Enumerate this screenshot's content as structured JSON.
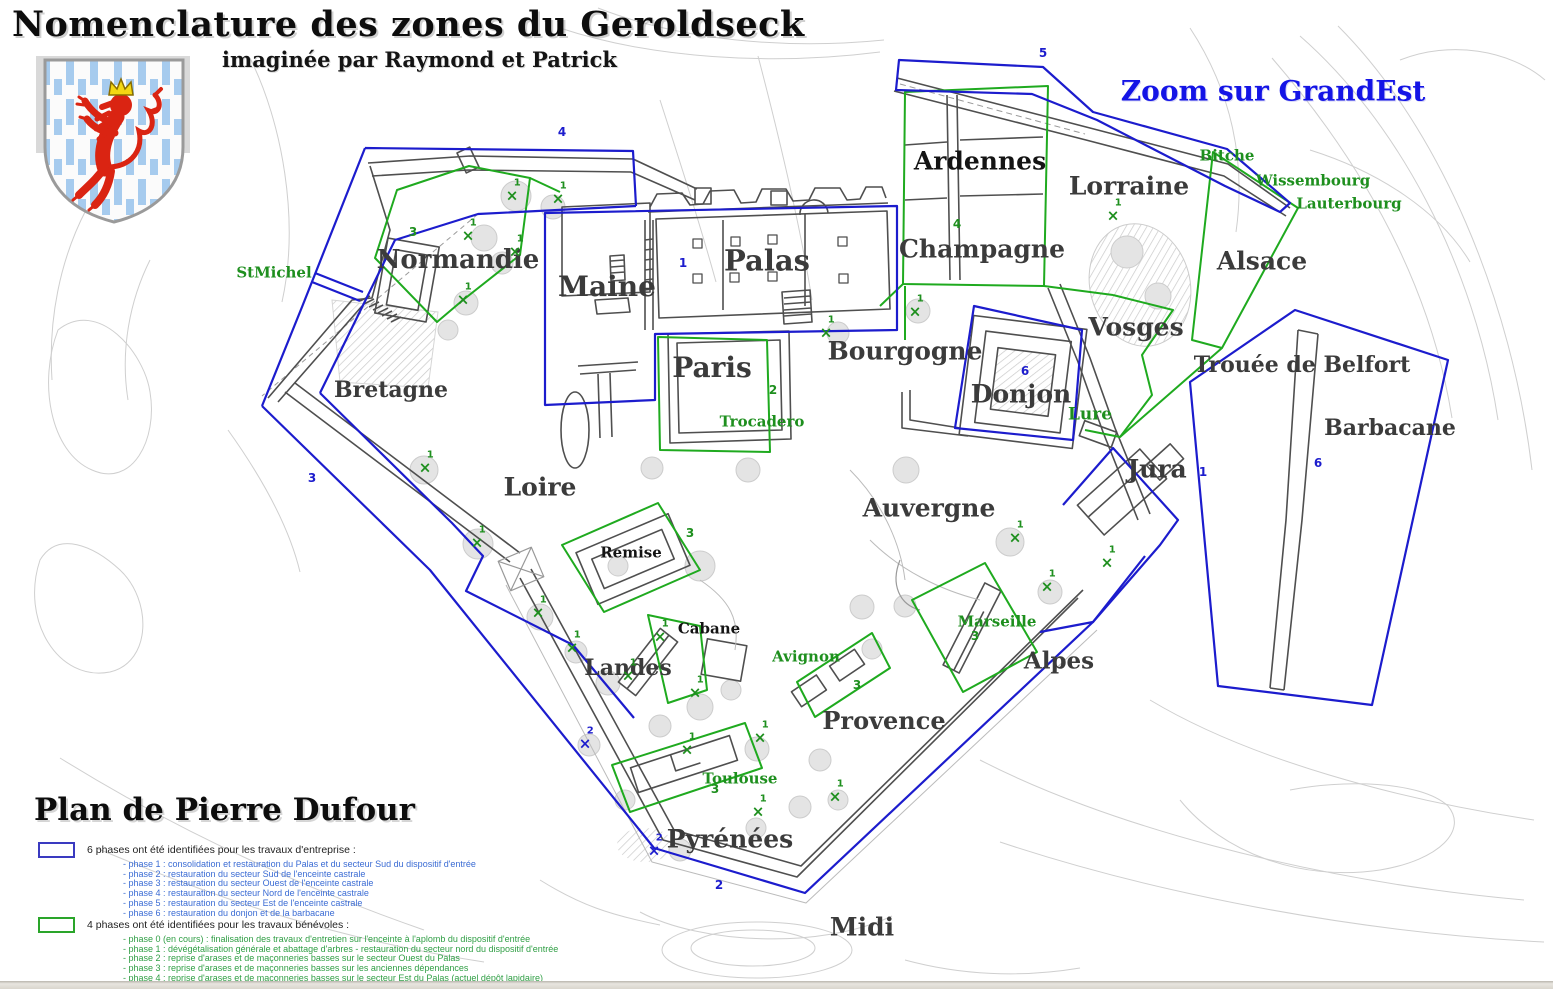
{
  "header": {
    "title": "Nomenclature des zones du Geroldseck",
    "subtitle": "imaginée par Raymond et Patrick",
    "zoom_note": "Zoom sur GrandEst",
    "plan_credit": "Plan de Pierre Dufour"
  },
  "colors": {
    "phase_blue": "#1c1ccd",
    "phase_green": "#1faa1f",
    "green_label": "#1e8f1e",
    "zoom_note_blue": "#1414e6",
    "legend_blue_text": "#3b6cd4",
    "legend_green_text": "#2f9e44",
    "region_label_dark": "#3b3b3b",
    "wall_gray": "#4f4f4f",
    "contour_gray": "#cfcfcf"
  },
  "legend_entreprise": {
    "header": "6 phases ont été identifiées pour les travaux d'entreprise :",
    "lines": [
      {
        "text": "- phase 1 : consolidation et restauration du Palas et du secteur Sud du dispositif d'entrée"
      },
      {
        "text": "- phase 2 : restauration du secteur Sud de l'enceinte castrale"
      },
      {
        "text": "- phase 3 : restauration du secteur Ouest de l'enceinte castrale"
      },
      {
        "text": "- phase 4 : restauration du secteur Nord de l'enceinte castrale"
      },
      {
        "text": "- phase 5 : restauration du secteur Est de l'enceinte castrale"
      },
      {
        "text": "- phase 6 : restauration du donjon et de la barbacane"
      }
    ]
  },
  "legend_benevoles": {
    "header": "4 phases ont été identifiées pour les travaux bénévoles :",
    "lines": [
      {
        "text": "- phase 0 (en cours) : finalisation des travaux d'entretien sur l'enceinte à l'aplomb du dispositif d'entrée"
      },
      {
        "text": "- phase 1 : dévégétalisation générale et abattage d'arbres - restauration du secteur nord du dispositif d'entrée"
      },
      {
        "text": "- phase 2 : reprise d'arases et de maçonneries basses sur le secteur Ouest du Palas"
      },
      {
        "text": "- phase 3 : reprise d'arases et de maçonneries basses sur les anciennes dépendances"
      },
      {
        "text": "- phase 4 : reprise d'arases et de maçonneries basses sur le secteur Est du Palas (actuel dépôt lapidaire)"
      }
    ]
  },
  "map": {
    "region_labels": [
      {
        "text": "Palas",
        "x": 767,
        "y": 261,
        "size": 29,
        "tone": "dark"
      },
      {
        "text": "Maine",
        "x": 607,
        "y": 287,
        "size": 28,
        "tone": "dark"
      },
      {
        "text": "Paris",
        "x": 712,
        "y": 368,
        "size": 28,
        "tone": "dark"
      },
      {
        "text": "Bourgogne",
        "x": 905,
        "y": 351,
        "size": 25,
        "tone": "dark"
      },
      {
        "text": "Normandie",
        "x": 458,
        "y": 260,
        "size": 26,
        "tone": "dark"
      },
      {
        "text": "Bretagne",
        "x": 391,
        "y": 390,
        "size": 22,
        "tone": "dark"
      },
      {
        "text": "Loire",
        "x": 540,
        "y": 487,
        "size": 25,
        "tone": "dark"
      },
      {
        "text": "Auvergne",
        "x": 929,
        "y": 508,
        "size": 25,
        "tone": "dark"
      },
      {
        "text": "Ardennes",
        "x": 980,
        "y": 161,
        "size": 25,
        "tone": "black"
      },
      {
        "text": "Lorraine",
        "x": 1129,
        "y": 186,
        "size": 25,
        "tone": "dark"
      },
      {
        "text": "Champagne",
        "x": 982,
        "y": 249,
        "size": 25,
        "tone": "dark"
      },
      {
        "text": "Alsace",
        "x": 1262,
        "y": 261,
        "size": 25,
        "tone": "dark"
      },
      {
        "text": "Vosges",
        "x": 1136,
        "y": 327,
        "size": 25,
        "tone": "dark"
      },
      {
        "text": "Trouée de Belfort",
        "x": 1302,
        "y": 365,
        "size": 22,
        "tone": "dark"
      },
      {
        "text": "Barbacane",
        "x": 1390,
        "y": 428,
        "size": 22,
        "tone": "dark"
      },
      {
        "text": "Donjon",
        "x": 1021,
        "y": 394,
        "size": 25,
        "tone": "dark"
      },
      {
        "text": "Jura",
        "x": 1157,
        "y": 469,
        "size": 25,
        "tone": "dark"
      },
      {
        "text": "Alpes",
        "x": 1059,
        "y": 661,
        "size": 23,
        "tone": "dark"
      },
      {
        "text": "Landes",
        "x": 628,
        "y": 668,
        "size": 22,
        "tone": "dark"
      },
      {
        "text": "Provence",
        "x": 884,
        "y": 721,
        "size": 24,
        "tone": "dark"
      },
      {
        "text": "Pyrénées",
        "x": 730,
        "y": 839,
        "size": 25,
        "tone": "dark"
      },
      {
        "text": "Midi",
        "x": 862,
        "y": 927,
        "size": 25,
        "tone": "dark"
      },
      {
        "text": "Remise",
        "x": 631,
        "y": 553,
        "size": 15,
        "tone": "black"
      },
      {
        "text": "Cabane",
        "x": 709,
        "y": 629,
        "size": 15,
        "tone": "black"
      }
    ],
    "place_labels_green": [
      {
        "text": "StMichel",
        "x": 274,
        "y": 273,
        "size": 15,
        "tone": "green"
      },
      {
        "text": "Bitche",
        "x": 1227,
        "y": 156,
        "size": 15,
        "tone": "green"
      },
      {
        "text": "Wissembourg",
        "x": 1313,
        "y": 181,
        "size": 15,
        "tone": "green"
      },
      {
        "text": "Lauterbourg",
        "x": 1349,
        "y": 204,
        "size": 15,
        "tone": "green"
      },
      {
        "text": "Trocadero",
        "x": 762,
        "y": 422,
        "size": 15,
        "tone": "green"
      },
      {
        "text": "Lure",
        "x": 1090,
        "y": 415,
        "size": 17,
        "tone": "green"
      },
      {
        "text": "Marseille",
        "x": 997,
        "y": 622,
        "size": 15,
        "tone": "green"
      },
      {
        "text": "Avignon",
        "x": 806,
        "y": 657,
        "size": 15,
        "tone": "green"
      },
      {
        "text": "Toulouse",
        "x": 740,
        "y": 779,
        "size": 15,
        "tone": "green"
      }
    ],
    "zone_numbers": [
      {
        "text": "5",
        "x": 1043,
        "y": 53,
        "tone": "blue"
      },
      {
        "text": "4",
        "x": 562,
        "y": 132,
        "tone": "blue"
      },
      {
        "text": "3",
        "x": 312,
        "y": 478,
        "tone": "blue"
      },
      {
        "text": "2",
        "x": 719,
        "y": 885,
        "tone": "blue"
      },
      {
        "text": "1",
        "x": 683,
        "y": 263,
        "tone": "blue"
      },
      {
        "text": "6",
        "x": 1025,
        "y": 371,
        "tone": "blue"
      },
      {
        "text": "6",
        "x": 1318,
        "y": 463,
        "tone": "blue"
      },
      {
        "text": "1",
        "x": 1203,
        "y": 472,
        "tone": "blue"
      },
      {
        "text": "3",
        "x": 413,
        "y": 232,
        "tone": "green"
      },
      {
        "text": "4",
        "x": 957,
        "y": 224,
        "tone": "green"
      },
      {
        "text": "2",
        "x": 773,
        "y": 390,
        "tone": "green"
      },
      {
        "text": "3",
        "x": 690,
        "y": 533,
        "tone": "green"
      },
      {
        "text": "3",
        "x": 857,
        "y": 685,
        "tone": "green"
      },
      {
        "text": "3",
        "x": 715,
        "y": 789,
        "tone": "green"
      },
      {
        "text": "3",
        "x": 975,
        "y": 636,
        "tone": "green"
      }
    ],
    "marker_glyph": "×",
    "markers": [
      {
        "label": "1",
        "x": 512,
        "y": 196,
        "tone": "green"
      },
      {
        "label": "1",
        "x": 558,
        "y": 199,
        "tone": "green"
      },
      {
        "label": "1",
        "x": 468,
        "y": 236,
        "tone": "green"
      },
      {
        "label": "1",
        "x": 515,
        "y": 252,
        "tone": "green"
      },
      {
        "label": "1",
        "x": 463,
        "y": 300,
        "tone": "green"
      },
      {
        "label": "1",
        "x": 425,
        "y": 468,
        "tone": "green"
      },
      {
        "label": "1",
        "x": 477,
        "y": 543,
        "tone": "green"
      },
      {
        "label": "1",
        "x": 538,
        "y": 613,
        "tone": "green"
      },
      {
        "label": "1",
        "x": 572,
        "y": 648,
        "tone": "green"
      },
      {
        "label": "1",
        "x": 660,
        "y": 637,
        "tone": "green"
      },
      {
        "label": "1",
        "x": 628,
        "y": 676,
        "tone": "green"
      },
      {
        "label": "1",
        "x": 695,
        "y": 693,
        "tone": "green"
      },
      {
        "label": "1",
        "x": 687,
        "y": 750,
        "tone": "green"
      },
      {
        "label": "1",
        "x": 760,
        "y": 738,
        "tone": "green"
      },
      {
        "label": "1",
        "x": 758,
        "y": 812,
        "tone": "green"
      },
      {
        "label": "1",
        "x": 835,
        "y": 797,
        "tone": "green"
      },
      {
        "label": "1",
        "x": 826,
        "y": 333,
        "tone": "green"
      },
      {
        "label": "1",
        "x": 915,
        "y": 312,
        "tone": "green"
      },
      {
        "label": "1",
        "x": 1113,
        "y": 216,
        "tone": "green"
      },
      {
        "label": "1",
        "x": 1015,
        "y": 538,
        "tone": "green"
      },
      {
        "label": "1",
        "x": 1047,
        "y": 587,
        "tone": "green"
      },
      {
        "label": "1",
        "x": 1107,
        "y": 563,
        "tone": "green"
      },
      {
        "label": "2",
        "x": 585,
        "y": 744,
        "tone": "blue"
      },
      {
        "label": "2",
        "x": 654,
        "y": 851,
        "tone": "blue"
      }
    ]
  }
}
